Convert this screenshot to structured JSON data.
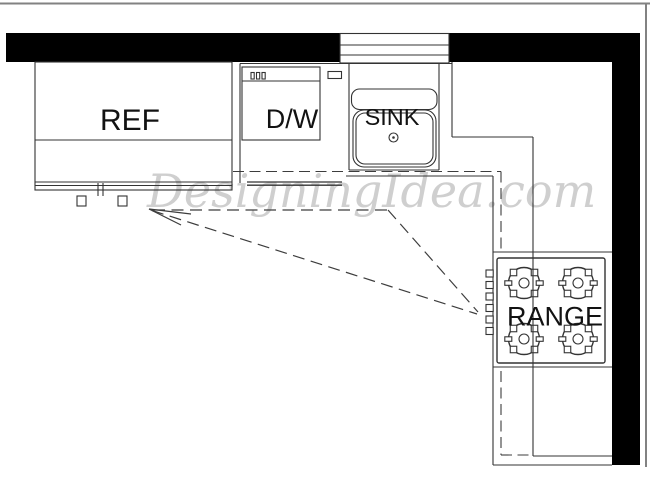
{
  "diagram": {
    "type": "kitchen-floor-plan-work-triangle",
    "watermark": "DesigningIdea.com",
    "labels": {
      "refrigerator": "REF",
      "dishwasher": "D/W",
      "sink": "SINK",
      "range": "RANGE"
    },
    "colors": {
      "wall": "#000000",
      "line": "#333333",
      "dashed": "#3d3d3d",
      "label": "#121212",
      "watermark": "#c7c7c7",
      "border": "#828282",
      "background": "#ffffff"
    }
  }
}
